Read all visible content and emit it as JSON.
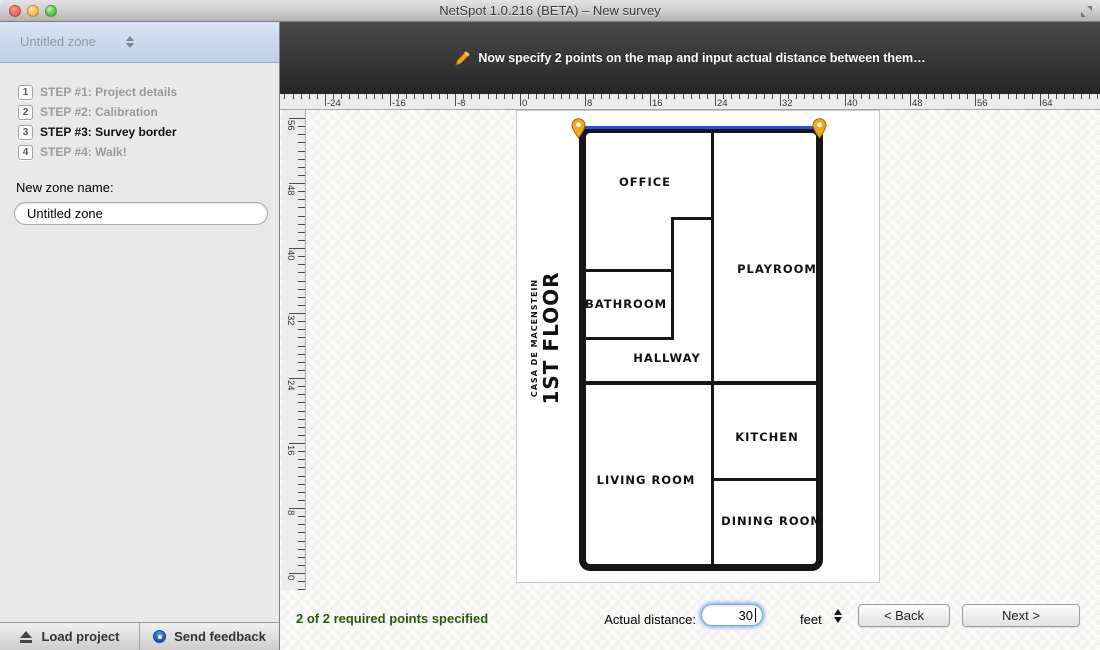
{
  "window": {
    "title": "NetSpot 1.0.216 (BETA) – New survey"
  },
  "sidebar": {
    "zone_selector": "Untitled zone",
    "steps": [
      {
        "num": "1",
        "label": "STEP #1: Project details",
        "state": "done"
      },
      {
        "num": "2",
        "label": "STEP #2: Calibration",
        "state": "done"
      },
      {
        "num": "3",
        "label": "STEP #3: Survey border",
        "state": "active"
      },
      {
        "num": "4",
        "label": "STEP #4: Walk!",
        "state": "pending"
      }
    ],
    "new_zone_label": "New zone name:",
    "new_zone_value": "Untitled zone",
    "footer": {
      "load_project": "Load project",
      "send_feedback": "Send feedback"
    }
  },
  "banner": {
    "message": "Now specify 2 points on the map and input actual distance between them…"
  },
  "rulers": {
    "top_labels": [
      "-24",
      "-16",
      "-8",
      "0",
      "8",
      "16",
      "24",
      "32",
      "40",
      "48",
      "56",
      "64"
    ],
    "left_labels": [
      "56",
      "48",
      "40",
      "32",
      "24",
      "16",
      "8",
      "0"
    ]
  },
  "floorplan": {
    "building_name": "CASA DE MACENSTEIN",
    "floor_name": "1ST FLOOR",
    "rooms": [
      {
        "label": "OFFICE",
        "x": 128,
        "y": 64
      },
      {
        "label": "PLAYROOM",
        "x": 260,
        "y": 151
      },
      {
        "label": "BATHROOM",
        "x": 109,
        "y": 186
      },
      {
        "label": "HALLWAY",
        "x": 150,
        "y": 240
      },
      {
        "label": "KITCHEN",
        "x": 250,
        "y": 319
      },
      {
        "label": "LIVING ROOM",
        "x": 129,
        "y": 362
      },
      {
        "label": "DINING ROOM",
        "x": 255,
        "y": 403
      }
    ]
  },
  "footer": {
    "status": "2 of 2 required points specified",
    "distance_label": "Actual distance:",
    "distance_value": "30",
    "unit": "feet",
    "back": "< Back",
    "next": "Next >"
  },
  "colors": {
    "status_green": "#2d5a0e",
    "pin_orange": "#f2a71f",
    "measure_blue": "#2b50dd",
    "focus_ring": "#7aa9e0"
  }
}
